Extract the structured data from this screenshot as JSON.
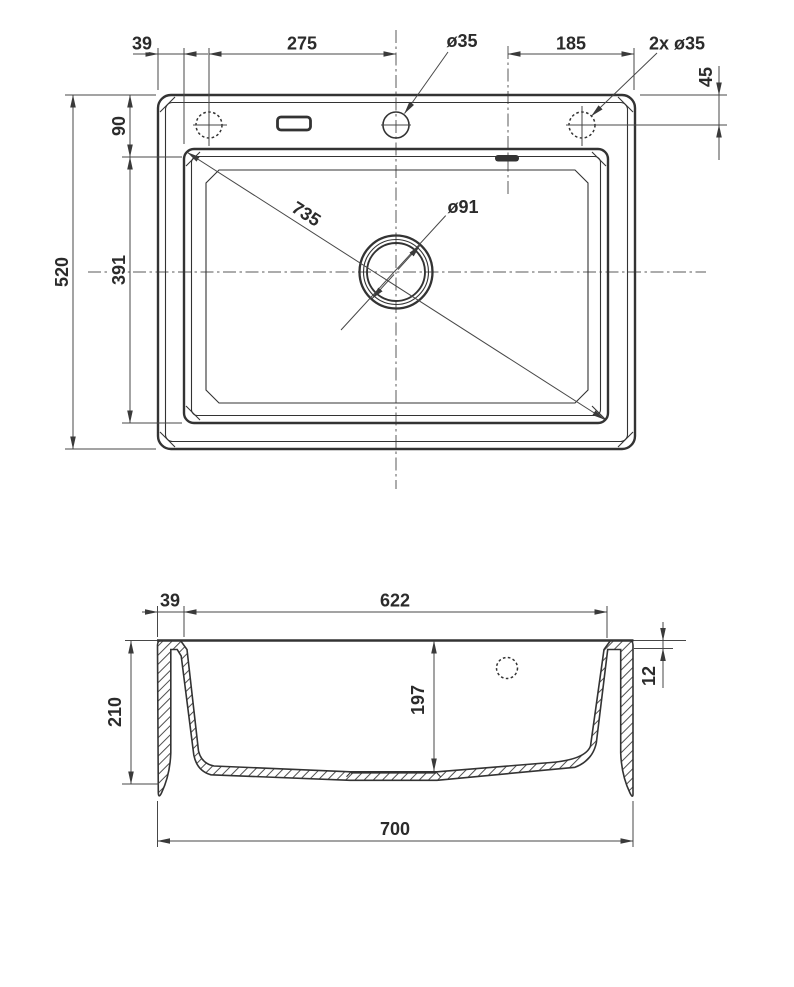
{
  "drawing": {
    "type": "sink-technical-drawing",
    "background": "#ffffff",
    "line_color": "#333333",
    "dimension_color": "#474747"
  },
  "top_view": {
    "dim_rim_left": "39",
    "dim_left_hole_to_tap": "275",
    "dim_tap_hole": "ø35",
    "dim_overflow_to_right_edge": "185",
    "dim_side_holes": "2x ø35",
    "dim_hole_from_top_edge": "45",
    "dim_rim_top": "90",
    "dim_overall_depth": "520",
    "dim_bowl_depth": "391",
    "dim_bowl_diagonal": "735",
    "dim_drain": "ø91"
  },
  "section_view": {
    "dim_rim_width": "39",
    "dim_bowl_width": "622",
    "dim_total_height": "210",
    "dim_bowl_height": "197",
    "dim_rim_height": "12",
    "dim_overall_width": "700"
  }
}
